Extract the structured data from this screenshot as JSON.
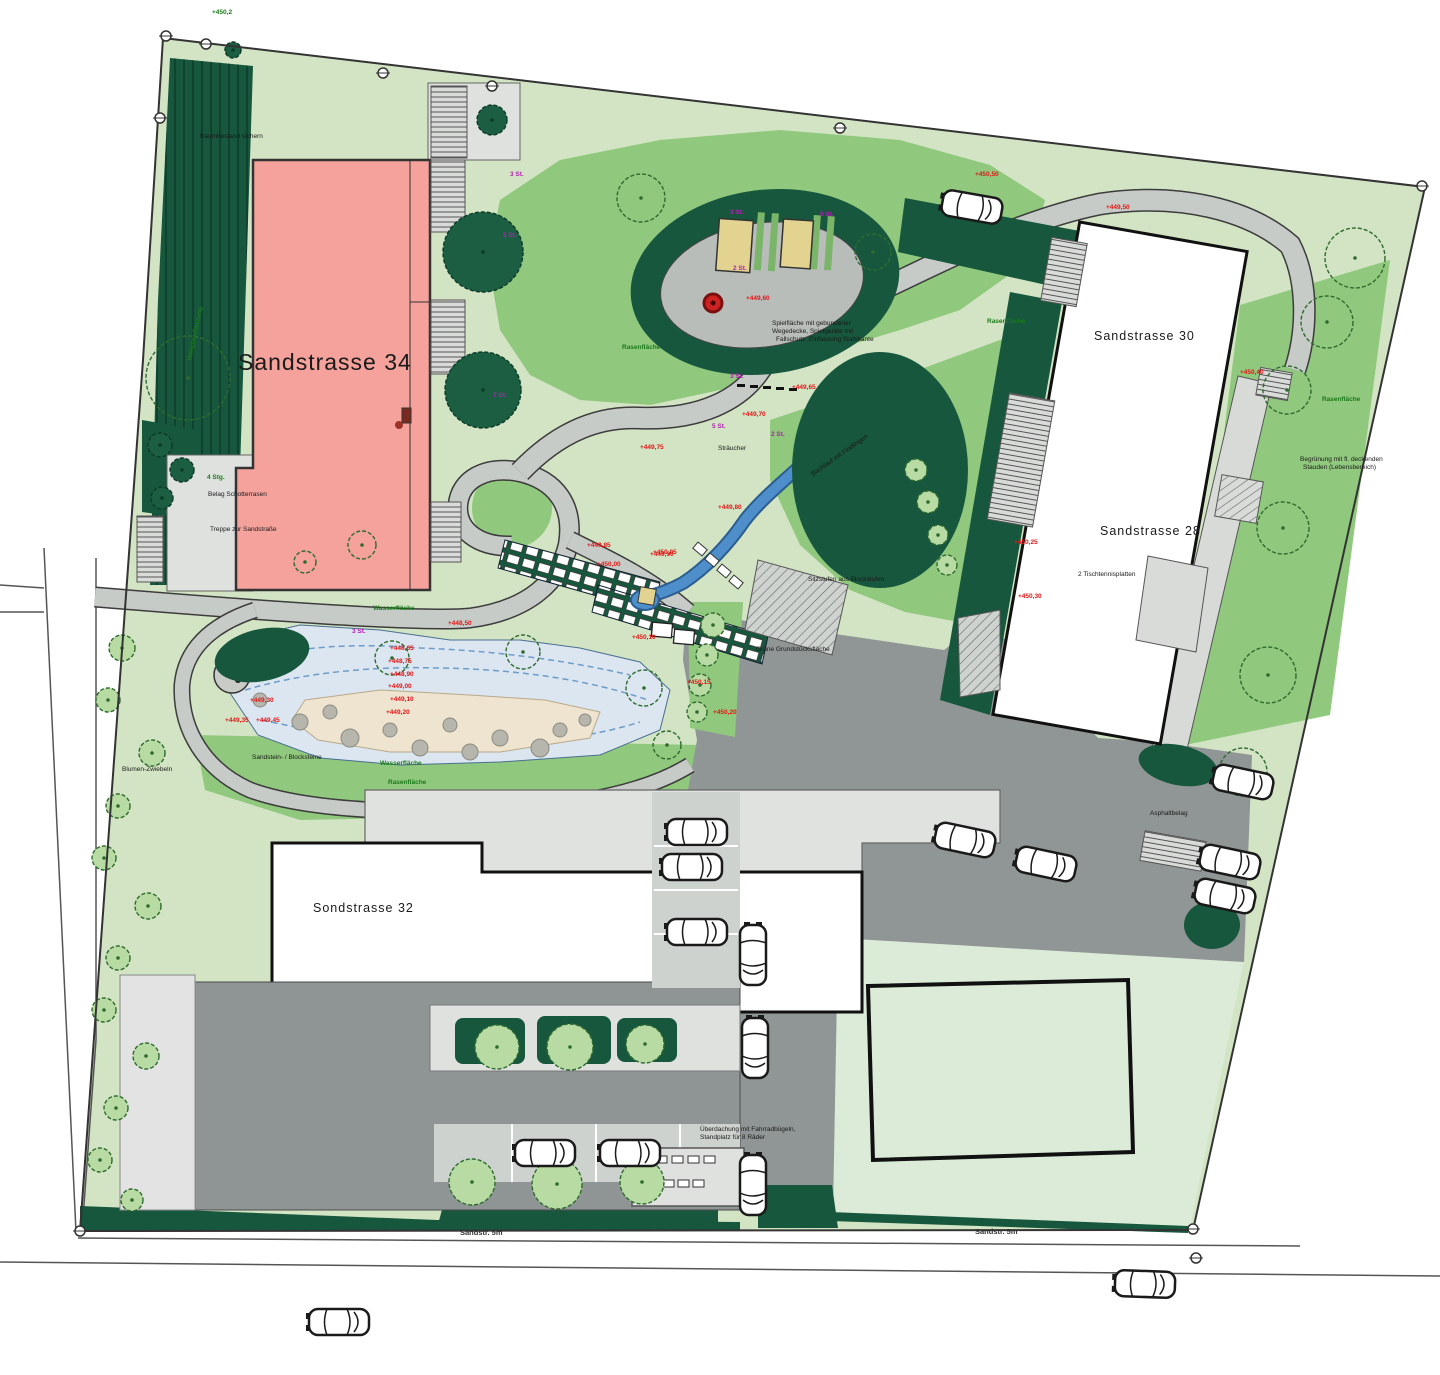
{
  "plan": {
    "type": "landscape-site-plan",
    "colors": {
      "parcel_lawn_pale": "#d2e4c3",
      "lawn_medium": "#90c87d",
      "field_pale": "#dcebd8",
      "hedge_dark": "#17573d",
      "asphalt": "#909695",
      "path_gray": "#c7cbc7",
      "court_gray": "#dfe1df",
      "building34_pink": "#f4a29b",
      "building_white": "#ffffff",
      "water_blue": "#4e8fcb",
      "pond_ring_blue": "#dce6f0",
      "gravel_beige": "#efe4cf",
      "annotation_red": "#e01818",
      "annotation_green": "#1b7a1b",
      "annotation_purple": "#b31fb3"
    }
  },
  "buildings": [
    {
      "id": "sandstrasse-34",
      "label": "Sandstrasse 34"
    },
    {
      "id": "sandstrasse-30",
      "label": "Sandstrasse 30"
    },
    {
      "id": "sandstrasse-28",
      "label": "Sandstrasse 28"
    },
    {
      "id": "sondstrasse-32",
      "label": "Sondstrasse 32"
    }
  ],
  "streets": [
    {
      "label": "Sandstr. 5m"
    },
    {
      "label": "Sandstr. 5m"
    }
  ],
  "annotations": [
    {
      "t": "+448,50",
      "x": 448,
      "y": 620,
      "c": "r"
    },
    {
      "t": "+448,65",
      "x": 390,
      "y": 645,
      "c": "r"
    },
    {
      "t": "+448,75",
      "x": 388,
      "y": 658,
      "c": "r"
    },
    {
      "t": "+448,90",
      "x": 390,
      "y": 671,
      "c": "r"
    },
    {
      "t": "+449,00",
      "x": 388,
      "y": 683,
      "c": "r"
    },
    {
      "t": "+449,10",
      "x": 390,
      "y": 696,
      "c": "r"
    },
    {
      "t": "+449,20",
      "x": 386,
      "y": 709,
      "c": "r"
    },
    {
      "t": "+449,30",
      "x": 250,
      "y": 697,
      "c": "r"
    },
    {
      "t": "+449,35",
      "x": 225,
      "y": 717,
      "c": "r"
    },
    {
      "t": "+449,45",
      "x": 256,
      "y": 717,
      "c": "r"
    },
    {
      "t": "+449,50",
      "x": 1106,
      "y": 204,
      "c": "r"
    },
    {
      "t": "+449,60",
      "x": 746,
      "y": 295,
      "c": "r"
    },
    {
      "t": "+449,65",
      "x": 792,
      "y": 384,
      "c": "r"
    },
    {
      "t": "+449,70",
      "x": 742,
      "y": 411,
      "c": "r"
    },
    {
      "t": "+449,75",
      "x": 640,
      "y": 444,
      "c": "r"
    },
    {
      "t": "+449,80",
      "x": 718,
      "y": 504,
      "c": "r"
    },
    {
      "t": "+449,85",
      "x": 587,
      "y": 542,
      "c": "r"
    },
    {
      "t": "+449,90",
      "x": 650,
      "y": 551,
      "c": "r"
    },
    {
      "t": "+450,00",
      "x": 597,
      "y": 561,
      "c": "r"
    },
    {
      "t": "+450,05",
      "x": 653,
      "y": 549,
      "c": "r"
    },
    {
      "t": "+450,10",
      "x": 632,
      "y": 634,
      "c": "r"
    },
    {
      "t": "+450,15",
      "x": 687,
      "y": 679,
      "c": "r"
    },
    {
      "t": "+450,20",
      "x": 713,
      "y": 709,
      "c": "r"
    },
    {
      "t": "+450,25",
      "x": 1014,
      "y": 539,
      "c": "r"
    },
    {
      "t": "+450,30",
      "x": 1018,
      "y": 593,
      "c": "r"
    },
    {
      "t": "+450,40",
      "x": 1240,
      "y": 369,
      "c": "r"
    },
    {
      "t": "+450,50",
      "x": 975,
      "y": 171,
      "c": "r"
    },
    {
      "t": "Wasserfläche",
      "x": 373,
      "y": 605,
      "c": "g"
    },
    {
      "t": "Wasserfläche",
      "x": 380,
      "y": 760,
      "c": "g"
    },
    {
      "t": "Rasenfläche",
      "x": 388,
      "y": 779,
      "c": "g"
    },
    {
      "t": "Rasenfläche",
      "x": 622,
      "y": 344,
      "c": "g"
    },
    {
      "t": "Rasenfläche",
      "x": 987,
      "y": 318,
      "c": "g"
    },
    {
      "t": "Rasenfläche",
      "x": 1322,
      "y": 396,
      "c": "g"
    },
    {
      "t": "4 Stg.",
      "x": 207,
      "y": 474,
      "c": "g"
    },
    {
      "t": "+450,2",
      "x": 212,
      "y": 9,
      "c": "g"
    },
    {
      "t": "Hangbepflanzung",
      "x": 168,
      "y": 330,
      "c": "g",
      "a": -78
    },
    {
      "t": "3 St.",
      "x": 510,
      "y": 171,
      "c": "p"
    },
    {
      "t": "5 St.",
      "x": 503,
      "y": 232,
      "c": "p"
    },
    {
      "t": "7 St.",
      "x": 493,
      "y": 392,
      "c": "p"
    },
    {
      "t": "3 St.",
      "x": 730,
      "y": 209,
      "c": "p"
    },
    {
      "t": "5 St.",
      "x": 820,
      "y": 211,
      "c": "p"
    },
    {
      "t": "2 St.",
      "x": 733,
      "y": 265,
      "c": "p"
    },
    {
      "t": "3 St.",
      "x": 730,
      "y": 373,
      "c": "p"
    },
    {
      "t": "5 St.",
      "x": 712,
      "y": 423,
      "c": "p"
    },
    {
      "t": "2 St.",
      "x": 771,
      "y": 431,
      "c": "p"
    },
    {
      "t": "3 St.",
      "x": 352,
      "y": 628,
      "c": "p"
    },
    {
      "t": "Baumbestand sichern",
      "x": 200,
      "y": 133,
      "c": "k"
    },
    {
      "t": "Belag Schotterrasen",
      "x": 208,
      "y": 491,
      "c": "k"
    },
    {
      "t": "Treppe zur Sandstraße",
      "x": 210,
      "y": 526,
      "c": "k"
    },
    {
      "t": "Blumen-Zwiebeln",
      "x": 122,
      "y": 766,
      "c": "k"
    },
    {
      "t": "Sandstein- / Blocksteine",
      "x": 252,
      "y": 754,
      "c": "k"
    },
    {
      "t": "Sitzstufen aus Blockstufen",
      "x": 808,
      "y": 576,
      "c": "k"
    },
    {
      "t": "2 Tischtennisplatten",
      "x": 1078,
      "y": 571,
      "c": "k"
    },
    {
      "t": "Grüne Grundstücksfläche",
      "x": 756,
      "y": 646,
      "c": "k"
    },
    {
      "t": "Bachlauf mit Findlingen",
      "x": 806,
      "y": 452,
      "c": "k",
      "a": -35
    },
    {
      "t": "Spielfläche mit gebundener",
      "x": 772,
      "y": 320,
      "c": "k"
    },
    {
      "t": "Wegedecke, Spielgeräte mit",
      "x": 772,
      "y": 328,
      "c": "k"
    },
    {
      "t": "Fallschutz, Einfassung Stahlkante",
      "x": 776,
      "y": 336,
      "c": "k"
    },
    {
      "t": "Überdachung mit Fahrradbügeln,",
      "x": 700,
      "y": 1126,
      "c": "k"
    },
    {
      "t": "Standplatz für 8 Räder",
      "x": 700,
      "y": 1134,
      "c": "k"
    },
    {
      "t": "Asphaltbelag",
      "x": 1150,
      "y": 810,
      "c": "k"
    },
    {
      "t": "Begrünung mit fl. deckenden",
      "x": 1300,
      "y": 456,
      "c": "k"
    },
    {
      "t": "Stauden (Lebensbereich)",
      "x": 1303,
      "y": 464,
      "c": "k"
    },
    {
      "t": "Sträucher",
      "x": 718,
      "y": 445,
      "c": "k"
    }
  ],
  "trees": [
    {
      "x": 188,
      "y": 378,
      "r": 42,
      "ty": "out"
    },
    {
      "x": 641,
      "y": 198,
      "r": 24,
      "ty": "out"
    },
    {
      "x": 873,
      "y": 252,
      "r": 18,
      "ty": "out"
    },
    {
      "x": 392,
      "y": 658,
      "r": 17,
      "ty": "out"
    },
    {
      "x": 523,
      "y": 652,
      "r": 17,
      "ty": "out"
    },
    {
      "x": 644,
      "y": 688,
      "r": 18,
      "ty": "out"
    },
    {
      "x": 667,
      "y": 745,
      "r": 14,
      "ty": "out"
    },
    {
      "x": 1268,
      "y": 675,
      "r": 28,
      "ty": "out"
    },
    {
      "x": 1355,
      "y": 258,
      "r": 30,
      "ty": "out"
    },
    {
      "x": 1327,
      "y": 322,
      "r": 26,
      "ty": "out"
    },
    {
      "x": 1287,
      "y": 390,
      "r": 24,
      "ty": "out"
    },
    {
      "x": 1283,
      "y": 528,
      "r": 26,
      "ty": "out"
    },
    {
      "x": 1243,
      "y": 772,
      "r": 24,
      "ty": "out"
    },
    {
      "x": 362,
      "y": 545,
      "r": 14,
      "ty": "out"
    },
    {
      "x": 305,
      "y": 562,
      "r": 11,
      "ty": "out"
    },
    {
      "x": 122,
      "y": 648,
      "r": 13,
      "ty": "lt"
    },
    {
      "x": 108,
      "y": 700,
      "r": 12,
      "ty": "lt"
    },
    {
      "x": 152,
      "y": 753,
      "r": 13,
      "ty": "lt"
    },
    {
      "x": 118,
      "y": 806,
      "r": 12,
      "ty": "lt"
    },
    {
      "x": 104,
      "y": 858,
      "r": 12,
      "ty": "lt"
    },
    {
      "x": 148,
      "y": 906,
      "r": 13,
      "ty": "lt"
    },
    {
      "x": 118,
      "y": 958,
      "r": 12,
      "ty": "lt"
    },
    {
      "x": 104,
      "y": 1010,
      "r": 12,
      "ty": "lt"
    },
    {
      "x": 146,
      "y": 1056,
      "r": 13,
      "ty": "lt"
    },
    {
      "x": 116,
      "y": 1108,
      "r": 12,
      "ty": "lt"
    },
    {
      "x": 100,
      "y": 1160,
      "r": 12,
      "ty": "lt"
    },
    {
      "x": 132,
      "y": 1200,
      "r": 11,
      "ty": "lt"
    },
    {
      "x": 472,
      "y": 1182,
      "r": 23,
      "ty": "lt"
    },
    {
      "x": 557,
      "y": 1184,
      "r": 25,
      "ty": "lt"
    },
    {
      "x": 642,
      "y": 1182,
      "r": 22,
      "ty": "lt"
    },
    {
      "x": 497,
      "y": 1047,
      "r": 22,
      "ty": "lt"
    },
    {
      "x": 570,
      "y": 1047,
      "r": 23,
      "ty": "lt"
    },
    {
      "x": 645,
      "y": 1044,
      "r": 19,
      "ty": "lt"
    },
    {
      "x": 916,
      "y": 470,
      "r": 11,
      "ty": "lt"
    },
    {
      "x": 928,
      "y": 502,
      "r": 11,
      "ty": "lt"
    },
    {
      "x": 938,
      "y": 535,
      "r": 10,
      "ty": "lt"
    },
    {
      "x": 947,
      "y": 565,
      "r": 10,
      "ty": "lt"
    },
    {
      "x": 713,
      "y": 625,
      "r": 12,
      "ty": "lt"
    },
    {
      "x": 707,
      "y": 655,
      "r": 11,
      "ty": "lt"
    },
    {
      "x": 700,
      "y": 685,
      "r": 11,
      "ty": "lt"
    },
    {
      "x": 697,
      "y": 712,
      "r": 10,
      "ty": "lt"
    },
    {
      "x": 483,
      "y": 252,
      "r": 40,
      "ty": "dk"
    },
    {
      "x": 483,
      "y": 390,
      "r": 38,
      "ty": "dk"
    },
    {
      "x": 492,
      "y": 120,
      "r": 15,
      "ty": "dk"
    },
    {
      "x": 160,
      "y": 445,
      "r": 12,
      "ty": "dk"
    },
    {
      "x": 182,
      "y": 470,
      "r": 12,
      "ty": "dk"
    },
    {
      "x": 162,
      "y": 498,
      "r": 11,
      "ty": "dk"
    },
    {
      "x": 233,
      "y": 50,
      "r": 8,
      "ty": "dk"
    }
  ],
  "stones": [
    {
      "x": 350,
      "y": 738,
      "r": 9
    },
    {
      "x": 420,
      "y": 748,
      "r": 8
    },
    {
      "x": 470,
      "y": 752,
      "r": 8
    },
    {
      "x": 540,
      "y": 748,
      "r": 9
    },
    {
      "x": 300,
      "y": 722,
      "r": 8
    },
    {
      "x": 330,
      "y": 712,
      "r": 7
    },
    {
      "x": 390,
      "y": 730,
      "r": 7
    },
    {
      "x": 500,
      "y": 738,
      "r": 8
    },
    {
      "x": 560,
      "y": 730,
      "r": 7
    },
    {
      "x": 585,
      "y": 720,
      "r": 6
    },
    {
      "x": 450,
      "y": 725,
      "r": 7
    },
    {
      "x": 260,
      "y": 700,
      "r": 7
    }
  ],
  "cars": [
    {
      "x": 697,
      "y": 832,
      "a": 0
    },
    {
      "x": 692,
      "y": 867,
      "a": 0
    },
    {
      "x": 697,
      "y": 932,
      "a": 0
    },
    {
      "x": 753,
      "y": 955,
      "a": 90
    },
    {
      "x": 755,
      "y": 1048,
      "a": 90
    },
    {
      "x": 753,
      "y": 1185,
      "a": 90
    },
    {
      "x": 545,
      "y": 1153,
      "a": 0
    },
    {
      "x": 630,
      "y": 1153,
      "a": 0
    },
    {
      "x": 965,
      "y": 840,
      "a": 12
    },
    {
      "x": 1046,
      "y": 864,
      "a": 12
    },
    {
      "x": 1243,
      "y": 782,
      "a": 12
    },
    {
      "x": 1230,
      "y": 862,
      "a": 12
    },
    {
      "x": 1225,
      "y": 896,
      "a": 12
    },
    {
      "x": 1145,
      "y": 1284,
      "a": 2
    },
    {
      "x": 339,
      "y": 1322,
      "a": 0
    },
    {
      "x": 972,
      "y": 207,
      "a": 10
    }
  ],
  "survey_markers": [
    {
      "x": 166,
      "y": 36
    },
    {
      "x": 206,
      "y": 44
    },
    {
      "x": 383,
      "y": 73
    },
    {
      "x": 492,
      "y": 86
    },
    {
      "x": 840,
      "y": 128
    },
    {
      "x": 1422,
      "y": 186
    },
    {
      "x": 1193,
      "y": 1229
    },
    {
      "x": 1196,
      "y": 1258
    },
    {
      "x": 80,
      "y": 1231
    },
    {
      "x": 160,
      "y": 118
    }
  ]
}
